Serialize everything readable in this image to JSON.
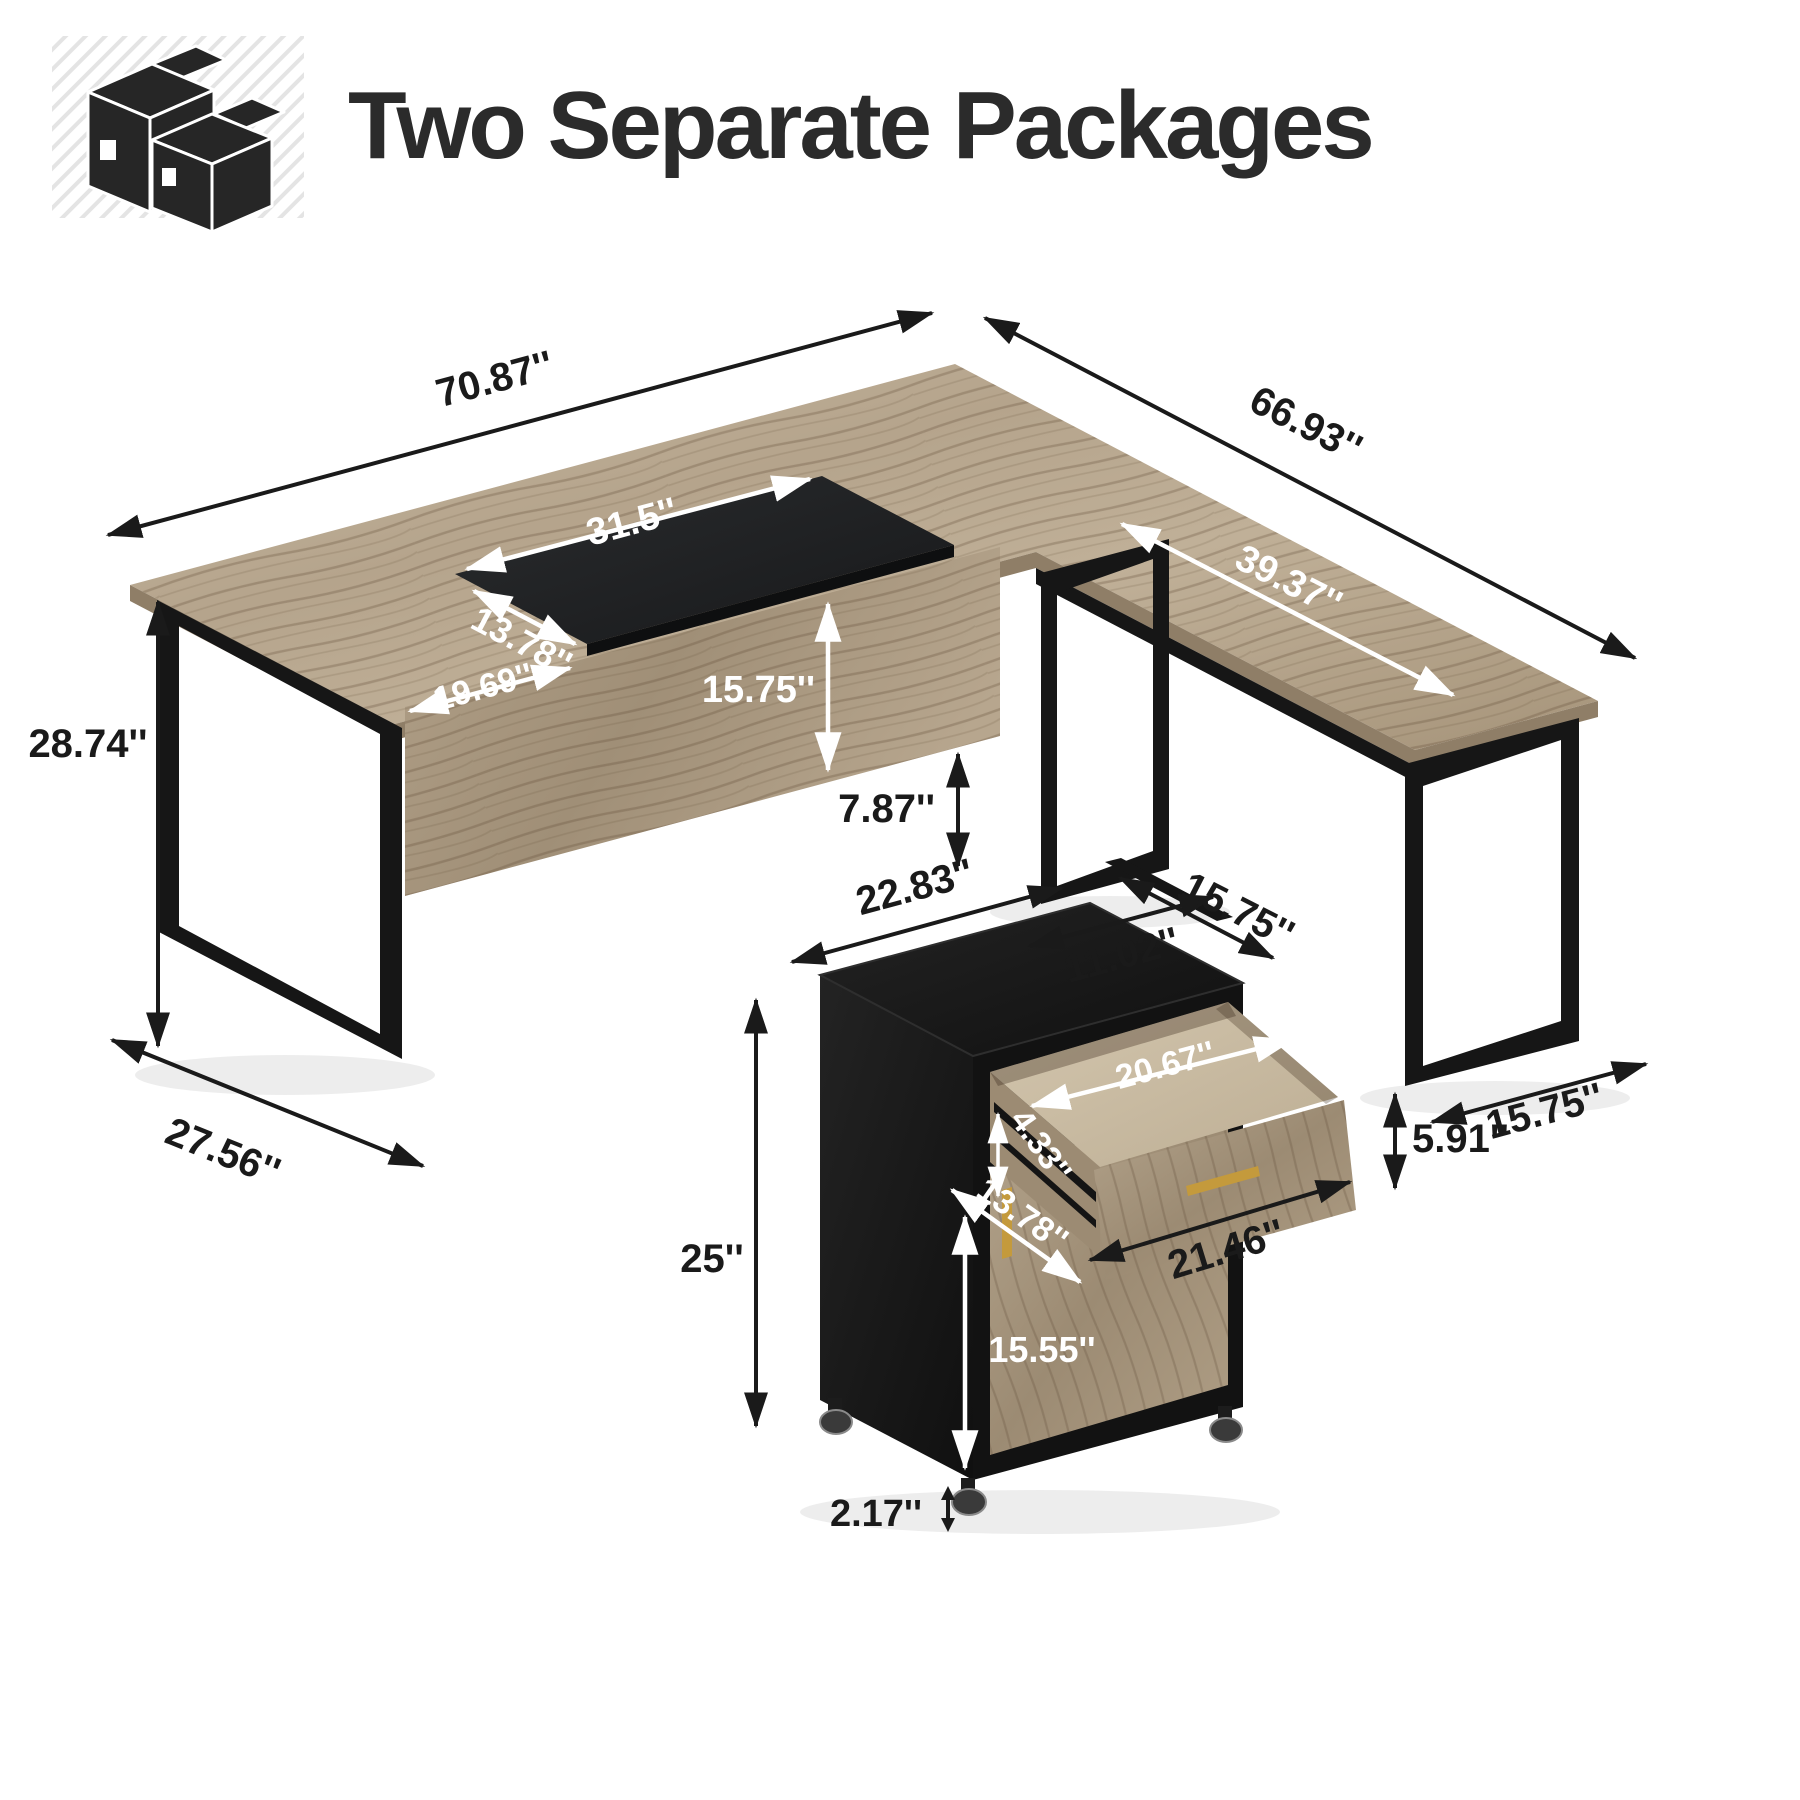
{
  "header": {
    "title": "Two Separate Packages",
    "icon": "packages-icon"
  },
  "palette": {
    "wood_light": "#c8b9a2",
    "wood_mid": "#b3a28a",
    "wood_dark": "#8d7b63",
    "inset_panel": "#1e2022",
    "metal_black": "#161616",
    "gold": "#c49a3c",
    "text_dark": "#1a1a1a",
    "text_light": "#ffffff"
  },
  "desk": {
    "name": "l-shaped-executive-desk",
    "dims": {
      "length": "70.87''",
      "return_length": "66.93''",
      "inset_width": "31.5''",
      "inset_depth": "13.78''",
      "left_surface_width": "19.69''",
      "front_panel_height": "15.75''",
      "height": "28.74''",
      "left_leg_depth": "27.56''",
      "panel_floor_gap": "7.87''",
      "middle_leg_width": "11.02''",
      "return_surface_length": "39.37''",
      "return_leg_width": "15.75''"
    }
  },
  "cabinet": {
    "name": "mobile-file-cabinet",
    "dims": {
      "top_width": "22.83''",
      "top_depth": "15.75''",
      "height": "25''",
      "drawer_inner_width": "20.67''",
      "drawer_inner_height": "4.33''",
      "drawer_front_height": "5.91''",
      "door_width": "13.78''",
      "door_height": "15.55''",
      "drawer_extension": "21.46''",
      "caster_height": "2.17''"
    }
  }
}
